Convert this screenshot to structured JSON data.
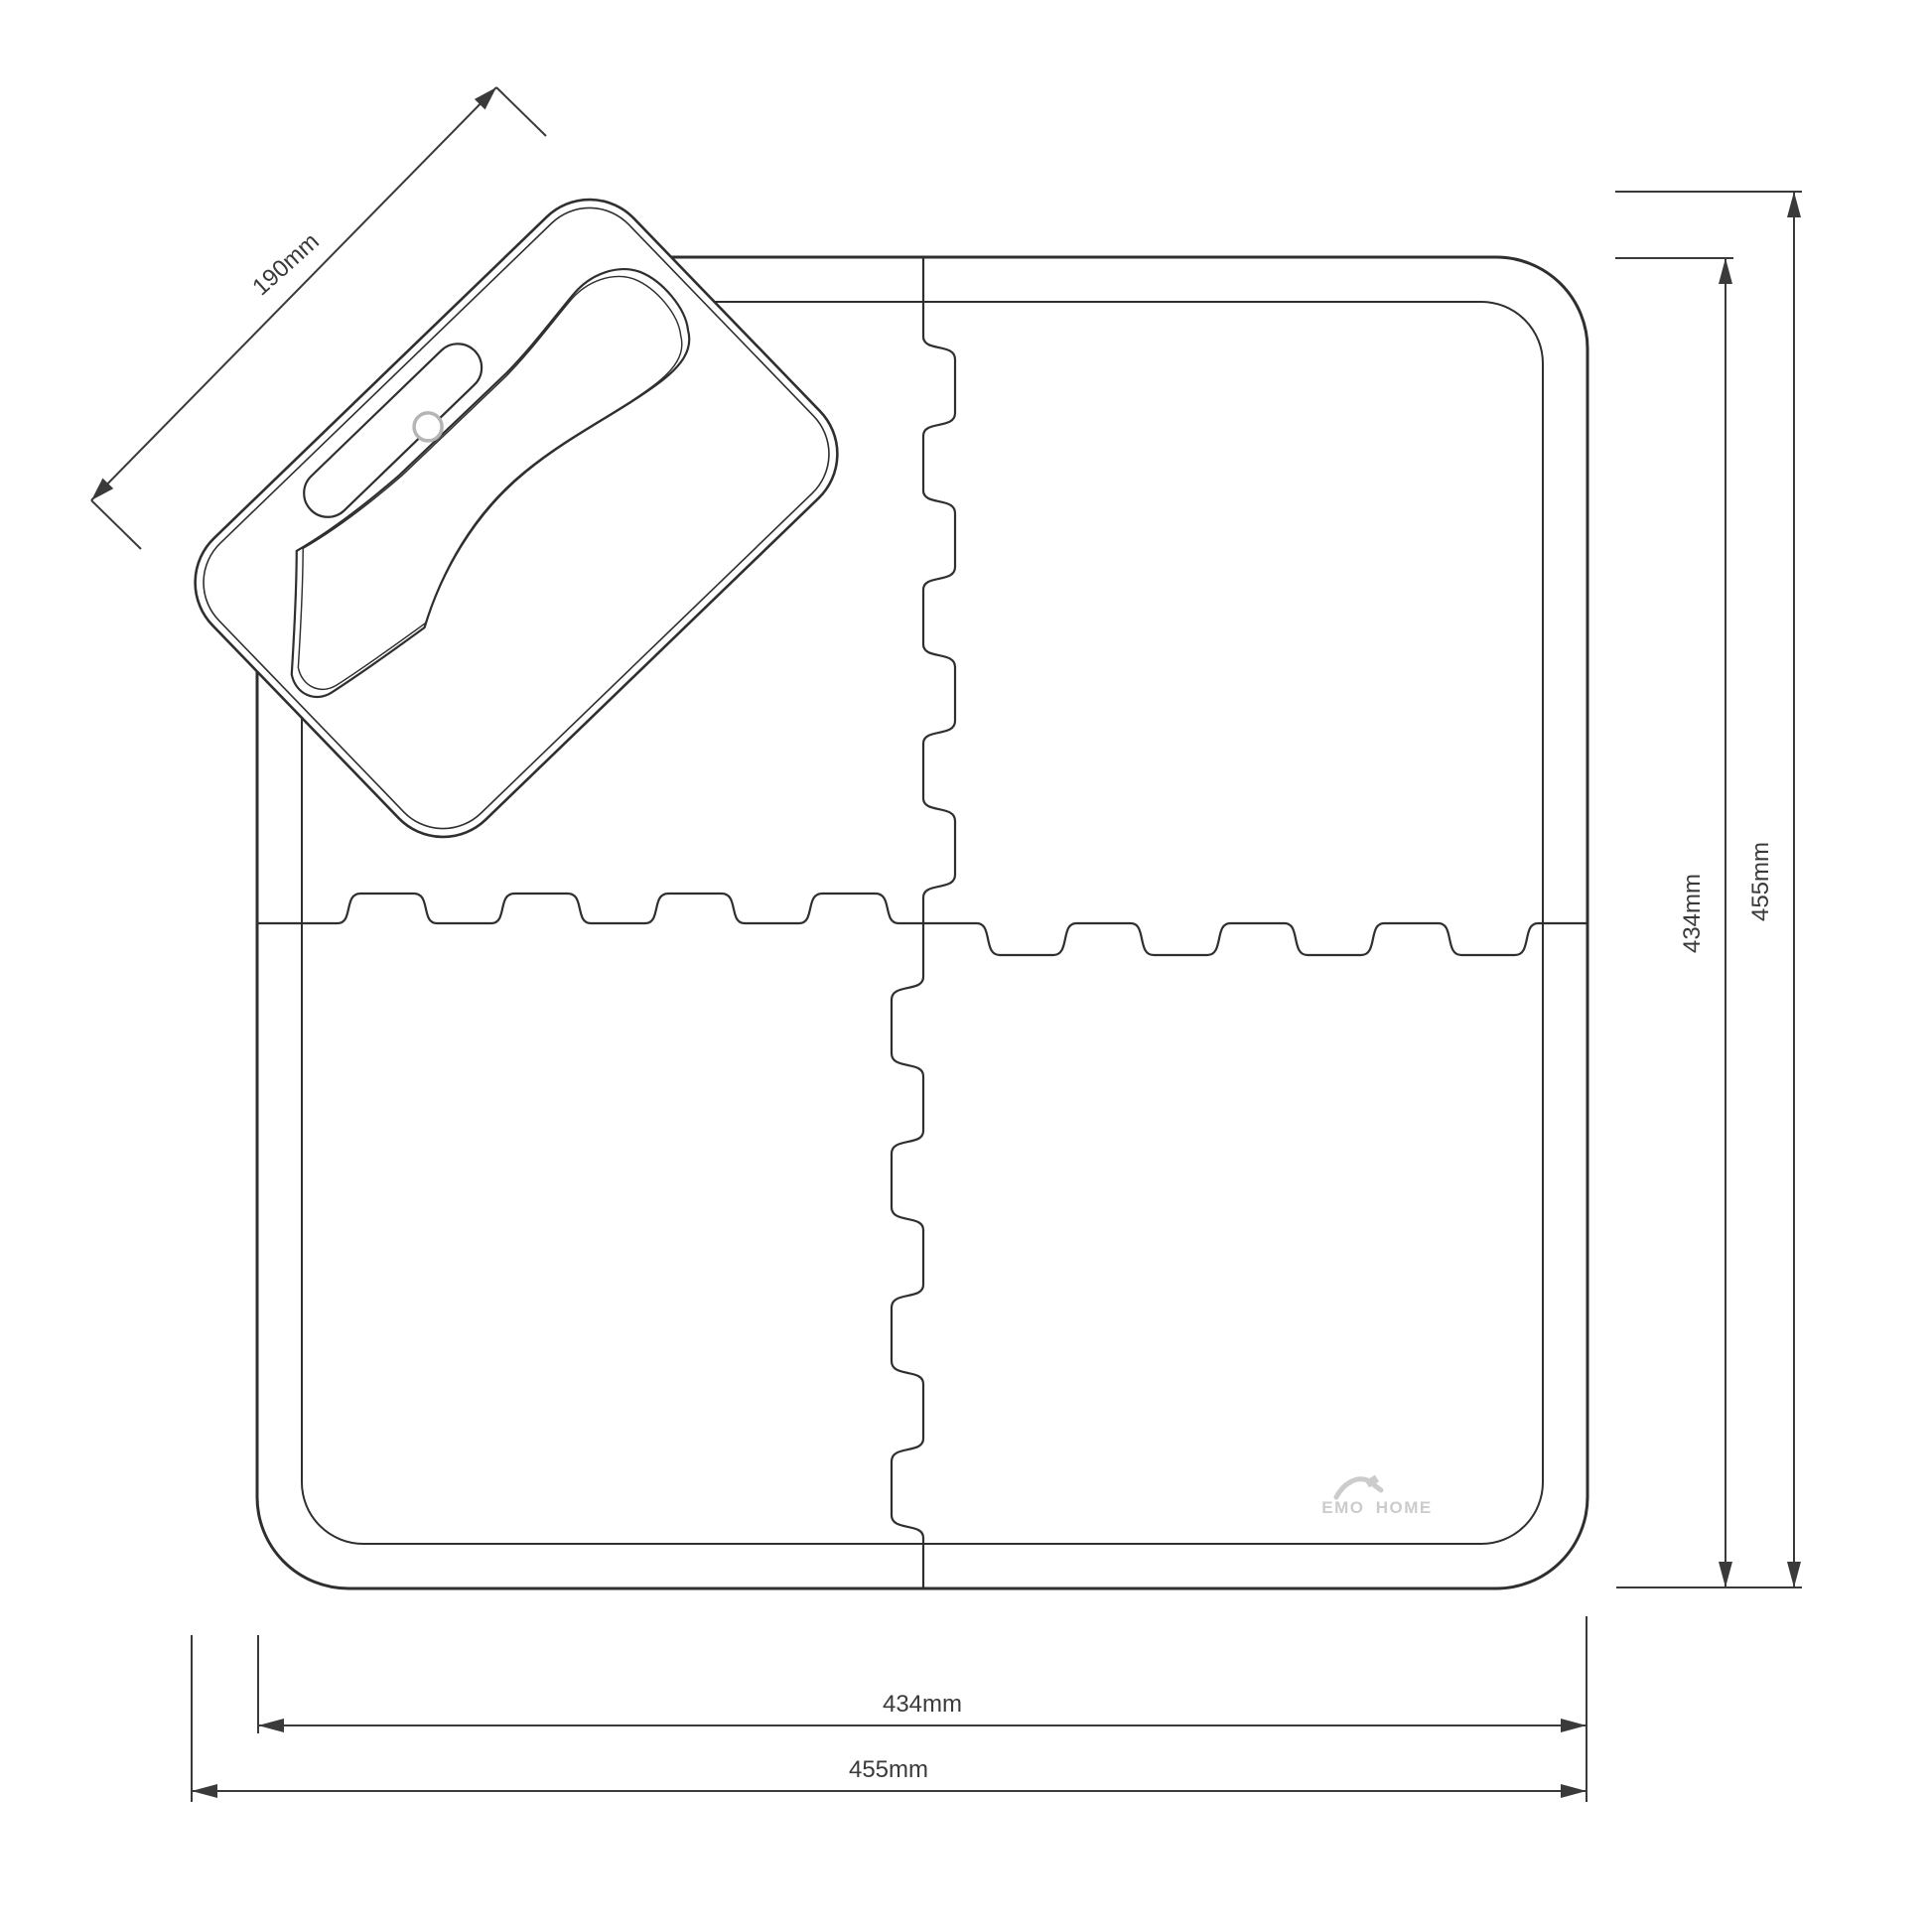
{
  "dimensions": {
    "piece_length": "190mm",
    "width_inner": "434mm",
    "width_outer": "455mm",
    "height_inner": "434mm",
    "height_outer": "455mm"
  },
  "logo": {
    "text": "EMO HOME"
  },
  "colors": {
    "line": "#2f2f2f",
    "dimension": "#3a3a3a",
    "logo": "#cccccc",
    "accent_circle": "#b5b5b5",
    "background": "#ffffff"
  }
}
